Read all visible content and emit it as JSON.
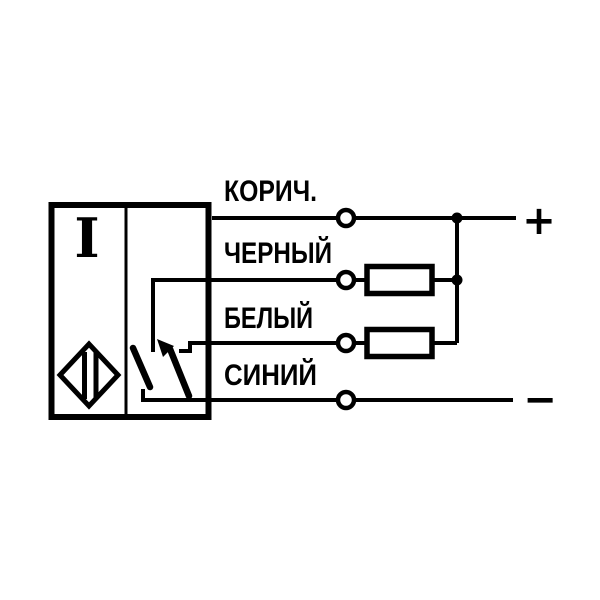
{
  "page": {
    "background": "#ffffff",
    "ink": "#000000"
  },
  "diagram": {
    "kind": "sensor-wiring-connection-diagram",
    "sensor": {
      "logic_symbol": "I",
      "sensor_icon": "non-contact-switch-diamond-icon",
      "switch_icon": "changeover-contact-with-arrow"
    },
    "wires": [
      {
        "label": "КОРИЧ.",
        "terminal": "open-circle",
        "component": "none"
      },
      {
        "label": "ЧЕРНЫЙ",
        "terminal": "open-circle",
        "component": "load-resistor"
      },
      {
        "label": "БЕЛЫЙ",
        "terminal": "open-circle",
        "component": "load-resistor"
      },
      {
        "label": "СИНИЙ",
        "terminal": "open-circle",
        "component": "none"
      }
    ],
    "polarity": {
      "positive": "+",
      "negative": "−"
    }
  }
}
